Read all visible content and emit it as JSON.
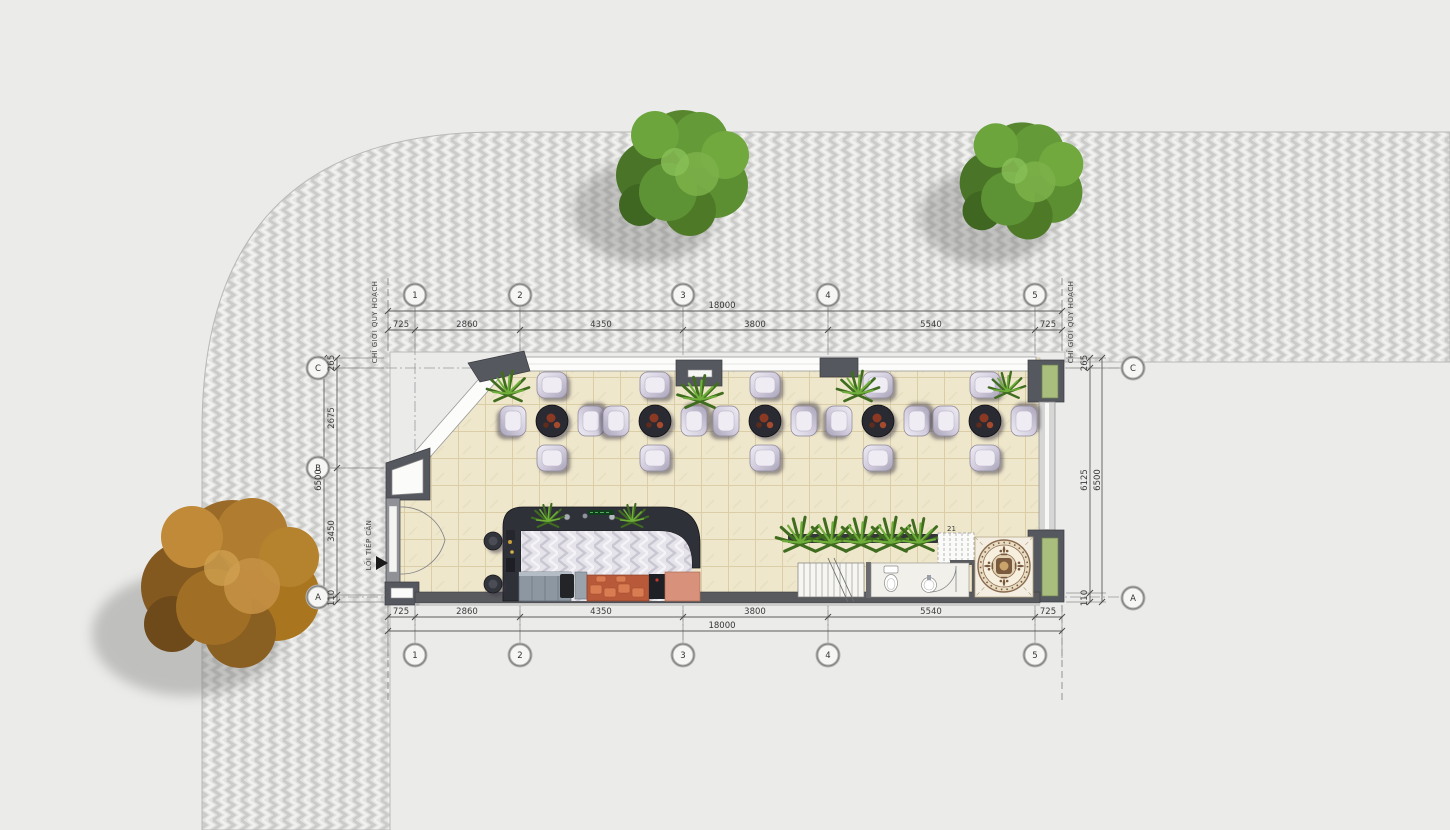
{
  "plan": {
    "type": "architectural-ground-floor-site-plan",
    "building_use": "cafe / coffee shop"
  },
  "annotations": {
    "planning_boundary_left": "CHỈ GIỚI QUY HOẠCH",
    "planning_boundary_right": "CHỈ GIỚI QUY HOẠCH",
    "access_path": "LỐI TIẾP CẬN",
    "stair_step_count": "21"
  },
  "grid": {
    "columns": [
      "1",
      "2",
      "3",
      "4",
      "5"
    ],
    "rows": [
      "C",
      "B",
      "A"
    ]
  },
  "dimensions": {
    "overall_width": "18000",
    "width_segments": [
      "725",
      "2860",
      "4350",
      "3800",
      "5540",
      "725"
    ],
    "overall_depth": "6500",
    "depth_segments_left": [
      "265",
      "2675",
      "3450",
      "110"
    ],
    "depth_segments_right": [
      "265",
      "6125",
      "110"
    ]
  },
  "colors": {
    "background": "#e9e9e8",
    "pavement_base": "#e3e3e2",
    "pavement_stripe": "#cccccb",
    "floor_tile": "#efe7cb",
    "wall_dark": "#56585f",
    "glazing_white": "#fcfcfb",
    "counter_dark": "#2f3138",
    "counter_top_herringbone": "#e6e4ea",
    "cabinet_orange": "#b85a3a",
    "facade_panel_green": "#a9bd7d",
    "foliage_green": "#5d9334",
    "foliage_autumn": "#a9761f",
    "chair_lavender": "#d6d1e0",
    "annotation_line": "#8a8a88"
  }
}
